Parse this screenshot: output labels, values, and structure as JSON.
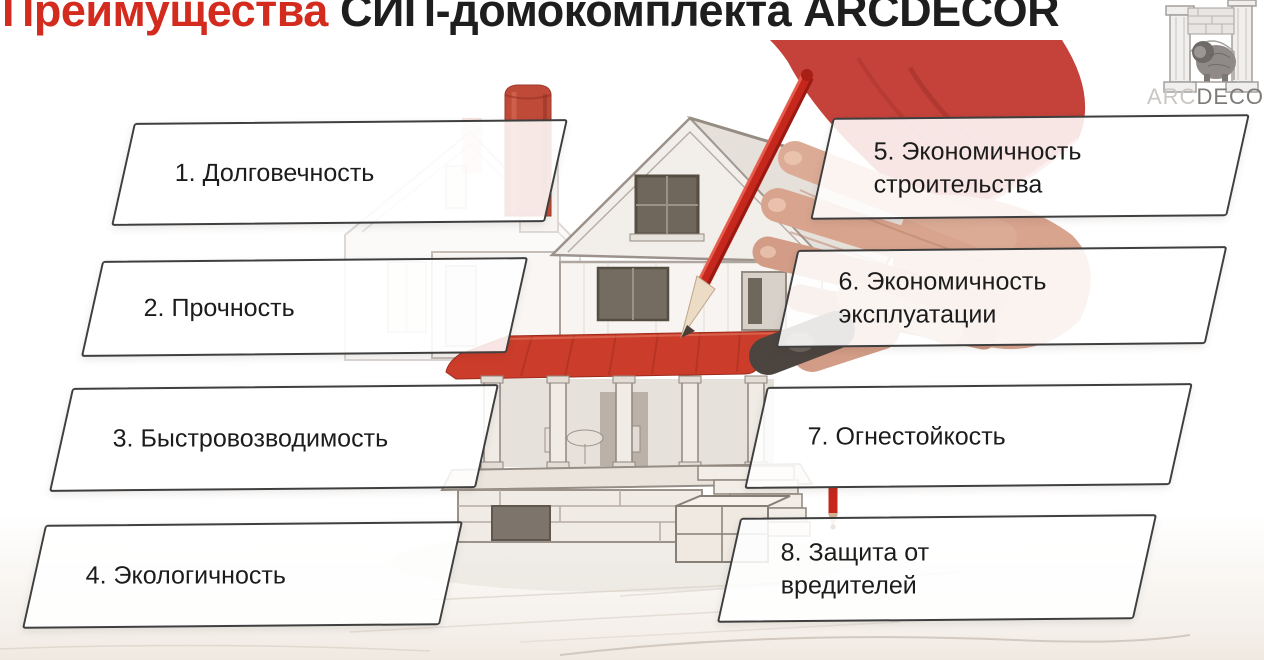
{
  "title": {
    "highlight": "Преимущества",
    "rest": "СИП-домокомплекта ARCDECOR"
  },
  "logo": {
    "brand_light": "ARC",
    "brand_dark": "DECOR",
    "emblem": "arch-lion-emblem"
  },
  "advantages": [
    "1. Долговечность",
    "2. Прочность",
    "3. Быстровозводимость",
    "4. Экологичность",
    "5. Экономичность строительства",
    "6. Экономичность эксплуатации",
    "7. Огнестойкость",
    "8. Защита от вредителей"
  ],
  "colors": {
    "title_accent": "#d32b1e",
    "title_dark": "#1e1e1e",
    "pencil_red": "#c5271c",
    "roof_red": "#cc3c2a",
    "chimney_red": "#c04a38",
    "box_border": "#3f3f3f"
  },
  "icons": {
    "illustration": "house-sketch-with-hand-and-red-pencil",
    "logo_emblem": "arch-lion-emblem"
  }
}
